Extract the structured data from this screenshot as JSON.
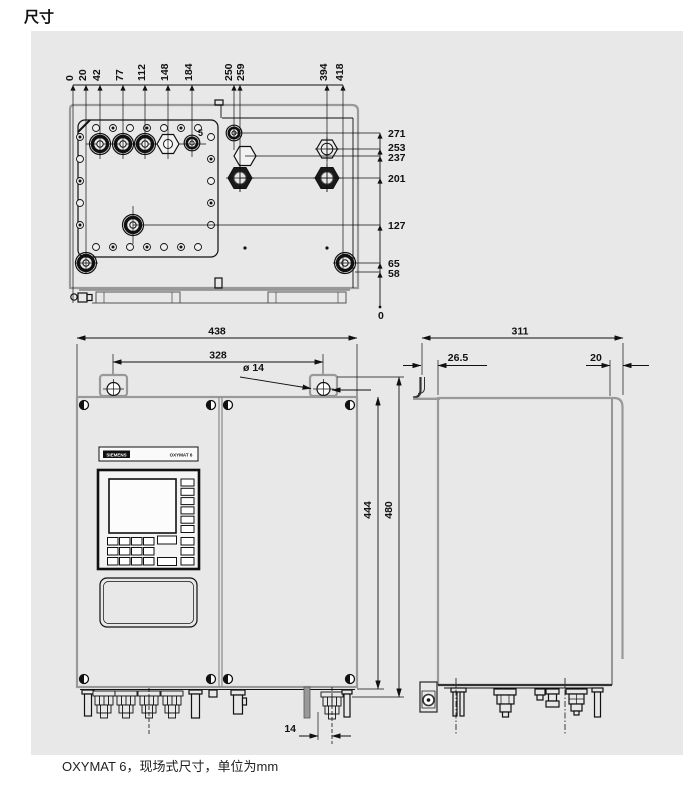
{
  "page": {
    "title": "尺寸",
    "caption": "OXYMAT 6，现场式尺寸，单位为mm"
  },
  "top_view": {
    "h_dims": [
      "0",
      "20",
      "42",
      "77",
      "112",
      "148",
      "184",
      "250",
      "259",
      "394",
      "418"
    ],
    "v_dims": [
      "271",
      "253",
      "237",
      "201",
      "127",
      "65",
      "58",
      "0"
    ],
    "gland_label": "5"
  },
  "front_view": {
    "overall_width": "438",
    "mount_hole_spacing": "328",
    "mount_hole_dia": "ø 14",
    "body_height": "444",
    "overall_height": "480",
    "gland_offset": "14",
    "brand": "SIEMENS",
    "model": "OXYMAT 6"
  },
  "side_view": {
    "overall_depth": "311",
    "bracket_offset": "26.5",
    "rear_panel_depth": "20"
  }
}
